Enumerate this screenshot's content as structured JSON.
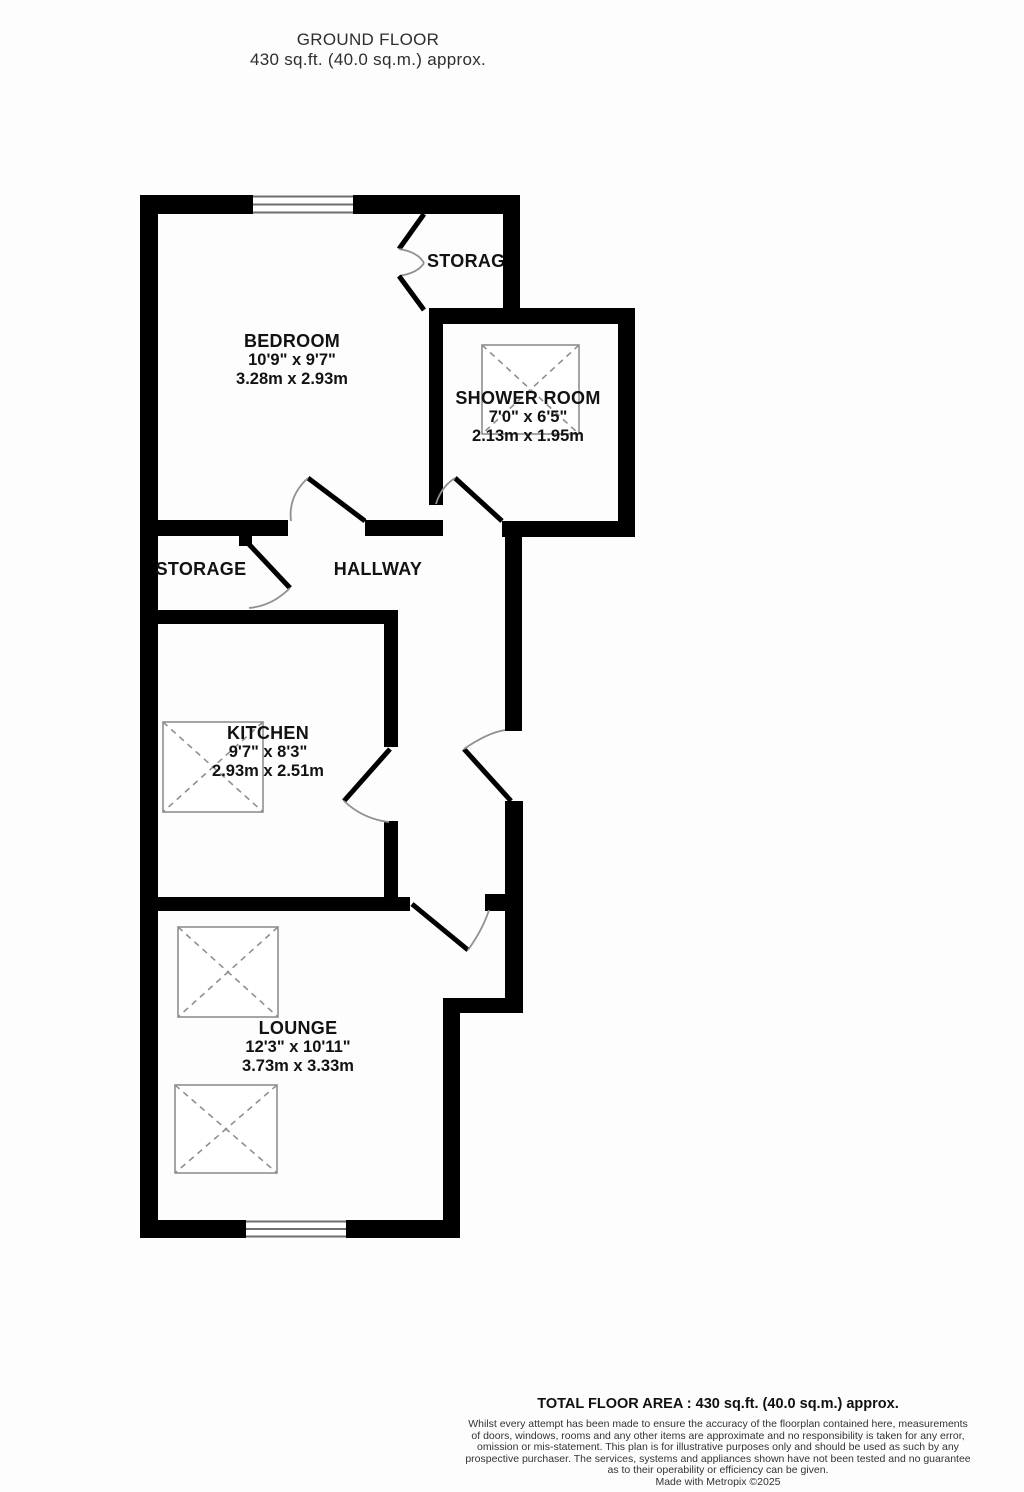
{
  "header": {
    "title": "GROUND FLOOR",
    "subtitle": "430 sq.ft. (40.0 sq.m.) approx."
  },
  "rooms": {
    "bedroom": {
      "name": "BEDROOM",
      "imperial": "10'9\" x 9'7\"",
      "metric": "3.28m x 2.93m"
    },
    "shower_room": {
      "name": "SHOWER ROOM",
      "imperial": "7'0\" x 6'5\"",
      "metric": "2.13m x 1.95m"
    },
    "kitchen": {
      "name": "KITCHEN",
      "imperial": "9'7\" x 8'3\"",
      "metric": "2.93m x 2.51m"
    },
    "lounge": {
      "name": "LOUNGE",
      "imperial": "12'3\" x 10'11\"",
      "metric": "3.73m x 3.33m"
    },
    "hallway": {
      "name": "HALLWAY"
    },
    "storage_top": {
      "name": "STORAGE"
    },
    "storage_left": {
      "name": "STORAGE"
    }
  },
  "footer": {
    "total": "TOTAL FLOOR AREA : 430 sq.ft. (40.0 sq.m.) approx.",
    "disclaimer_lines": [
      "Whilst every attempt has been made to ensure the accuracy of the floorplan contained here, measurements",
      "of doors, windows, rooms and any other items are approximate and no responsibility is taken for any error,",
      "omission or mis-statement. This plan is for illustrative purposes only and should be used as such by any",
      "prospective purchaser. The services, systems and appliances shown have not been tested and no guarantee",
      "as to their operability or efficiency can be given."
    ],
    "credit": "Made with Metropix ©2025"
  },
  "colors": {
    "wall": "#000000",
    "door_leaf": "#000000",
    "door_arc": "#909090",
    "symbol_gray": "#8f8f8f",
    "window_line": "#6e6e6e",
    "label_text": "#121212"
  }
}
